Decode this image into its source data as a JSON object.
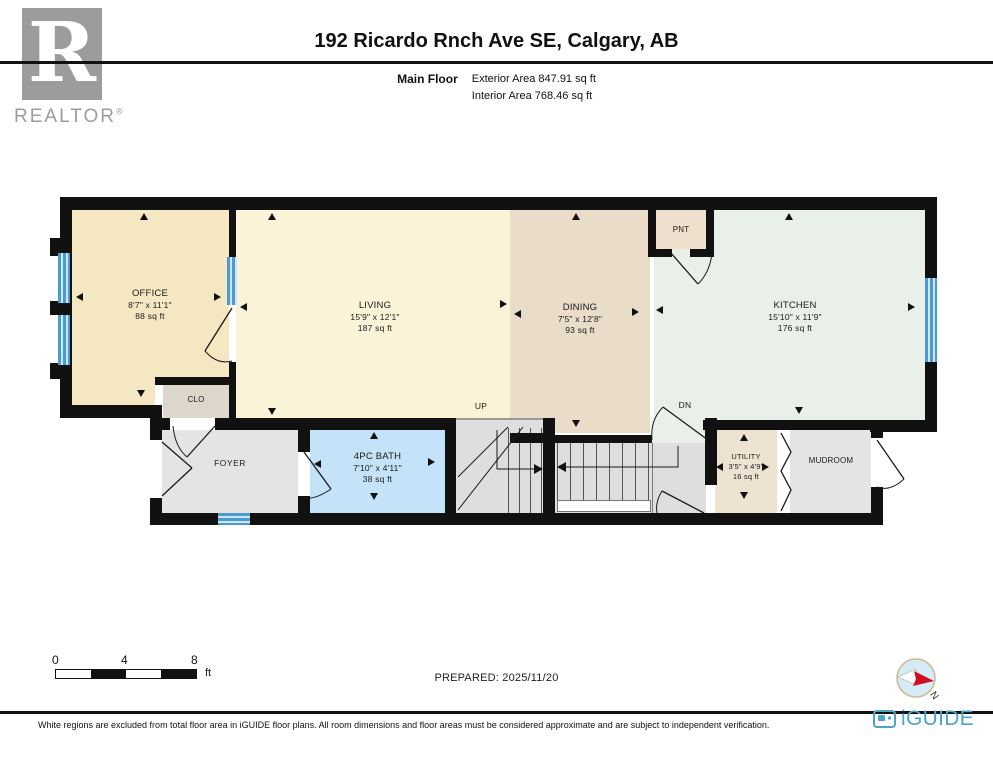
{
  "header": {
    "title": "192 Ricardo Rnch Ave SE, Calgary, AB",
    "floor_label": "Main Floor",
    "exterior_area": "Exterior Area 847.91 sq ft",
    "interior_area": "Interior Area 768.46 sq ft",
    "realtor_letter": "R",
    "realtor_word": "REALTOR",
    "realtor_reg": "®"
  },
  "rooms": {
    "office": {
      "name": "OFFICE",
      "dims": "8'7\" x 11'1\"",
      "area": "88 sq ft"
    },
    "living": {
      "name": "LIVING",
      "dims": "15'9\" x 12'1\"",
      "area": "187 sq ft"
    },
    "dining": {
      "name": "DINING",
      "dims": "7'5\" x 12'8\"",
      "area": "93 sq ft"
    },
    "kitchen": {
      "name": "KITCHEN",
      "dims": "15'10\" x 11'9\"",
      "area": "176 sq ft"
    },
    "bath": {
      "name": "4PC BATH",
      "dims": "7'10\" x 4'11\"",
      "area": "38 sq ft"
    },
    "utility": {
      "name": "UTILITY",
      "dims": "3'5\" x 4'9\"",
      "area": "16 sq ft"
    },
    "foyer": {
      "name": "FOYER"
    },
    "mudroom": {
      "name": "MUDROOM"
    },
    "clo": {
      "name": "CLO"
    },
    "pnt": {
      "name": "PNT"
    }
  },
  "stairs": {
    "up": "UP",
    "dn": "DN"
  },
  "scale": {
    "ticks": [
      "0",
      "4",
      "8"
    ],
    "unit": "ft"
  },
  "prepared": "PREPARED: 2025/11/20",
  "compass": {
    "n": "N"
  },
  "footer": {
    "disclaimer": "White regions are excluded from total floor area in iGUIDE floor plans. All room dimensions and floor areas must be considered approximate and are subject to independent verification.",
    "brand": "iGUIDE"
  },
  "colors": {
    "wall": "#111111",
    "office": "#f6e7c3",
    "living": "#fbf3d8",
    "dining": "#e9dcc9",
    "kitchen": "#e9f0ea",
    "bath": "#c4e2f8",
    "foyer": "#e4e4e4",
    "mudroom": "#e4e4e4",
    "stairs": "#dedede",
    "clo": "#ddd6cb",
    "pnt": "#eee0cd",
    "utility": "#eee3d0",
    "window_blue": "#4a9bd0",
    "iguide_blue": "#4aa6c8",
    "realtor_gray": "#9c9c9c",
    "compass_red": "#cf1020"
  }
}
